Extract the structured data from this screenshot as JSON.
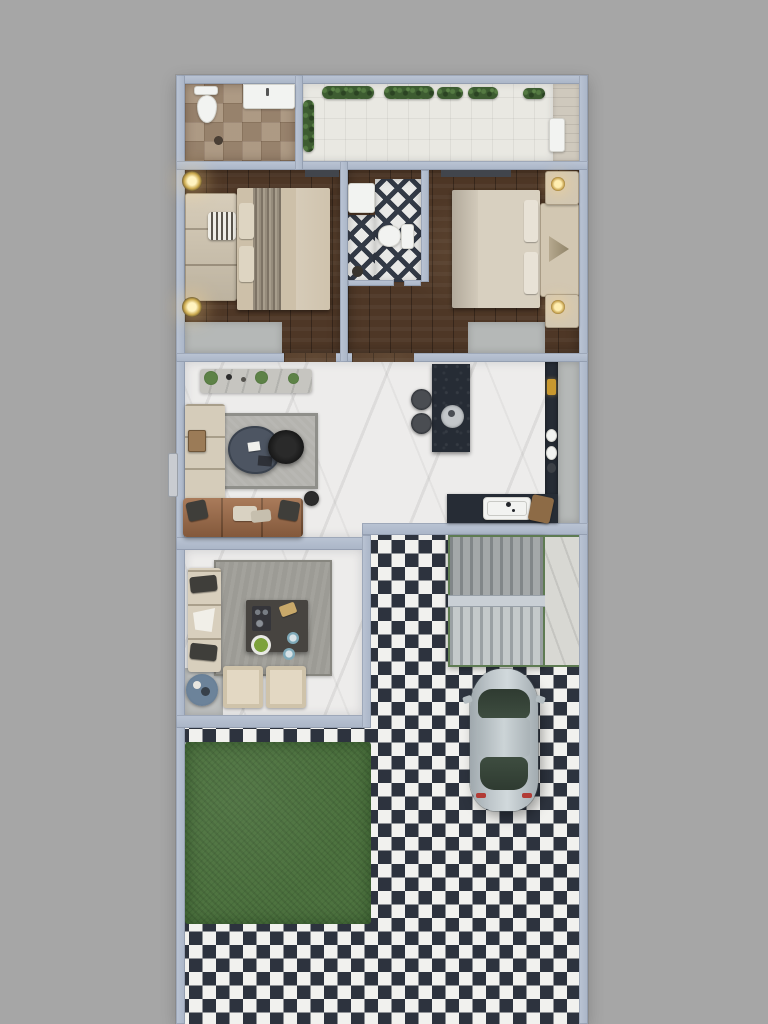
{
  "scene": {
    "type": "3d-floor-plan-top-view",
    "description": "Top-down 3D rendered floor plan of a narrow house: upper strip with patterned-tile bathroom and planted balcony; two wood-floor bedrooms with an en-suite lattice-tile bathroom between them; open living room and dark kitchen on white marble; dining room with rug and table; outside a black-and-white checkerboard driveway with a glass-canopy staircase, a parked silver car and a square lawn patch",
    "text_visible": "none"
  },
  "palette": {
    "background": "#a6a6a6",
    "wall": "#aab5c7",
    "wall_hi": "#bac4d4",
    "wood": "#4e3726",
    "marble": "#edeceb",
    "concrete": "#b5b8b7",
    "checker_dark": "#2d333e",
    "checker_light": "#f1f1ee",
    "grass": "#4e7340",
    "hedge": "#3d5c31",
    "tile_brown": "#a5917c",
    "lattice": "#333a46",
    "beige": "#d2c7b2",
    "beige_light": "#e3dac6",
    "brown_sofa": "#a06c48",
    "dark_counter": "#262c35",
    "slate": "#4d5562",
    "rug_living": "#b4b3ae",
    "rug_dining": "#9c9b95",
    "blue_table": "#5b7288",
    "car_body": "#bfc7cb",
    "car_glass": "#3e4d40",
    "gold": "#c8982f",
    "canopy_light": "#c4c9ca",
    "canopy_dark": "#9aa0a3",
    "canopy_edge": "#5e7b52",
    "landing": "#c9cfd5",
    "white": "#f2f3f1"
  },
  "areas": {
    "top_bathroom": [
      "moroccan-tile-floor",
      "toilet",
      "vanity-sink",
      "floor-drain"
    ],
    "balcony": [
      "white-tile-floor",
      "hedge-planters",
      "wood-deck-strip",
      "white-mat"
    ],
    "bedroom_left": [
      "double-bed",
      "striped-runner",
      "headboard-bench",
      "striped-pillow",
      "two-ceiling-spotlights",
      "closet-floor-mat"
    ],
    "ensuite_bathroom": [
      "lattice-tile-floor",
      "sink-counter",
      "toilet"
    ],
    "bedroom_right": [
      "double-bed",
      "headboard",
      "two-nightstands",
      "two-table-lamps",
      "closet-floor-mat"
    ],
    "living_room": [
      "console-with-plants",
      "white-corner-sofa",
      "wood-side-table",
      "gray-area-rug",
      "triangular-coffee-table",
      "black-fur-pouf",
      "leather-sofa-with-pillows",
      "small-black-stool",
      "entry-door"
    ],
    "kitchen": [
      "dark-island",
      "two-bar-stools",
      "round-serving-tray",
      "dark-wall-counter",
      "white-sink-with-faucet",
      "cutting-board",
      "counter-items"
    ],
    "dining_room": [
      "gray-rug",
      "dark-square-table",
      "serving-tray",
      "bread-board",
      "salad-bowl",
      "blue-plates",
      "bench-sofa-with-pillows",
      "two-beige-chairs",
      "round-blue-side-table"
    ],
    "exterior": [
      "checkerboard-paving",
      "lawn-square",
      "glass-canopy-over-staircase",
      "stair-landing",
      "parked-silver-car"
    ]
  }
}
